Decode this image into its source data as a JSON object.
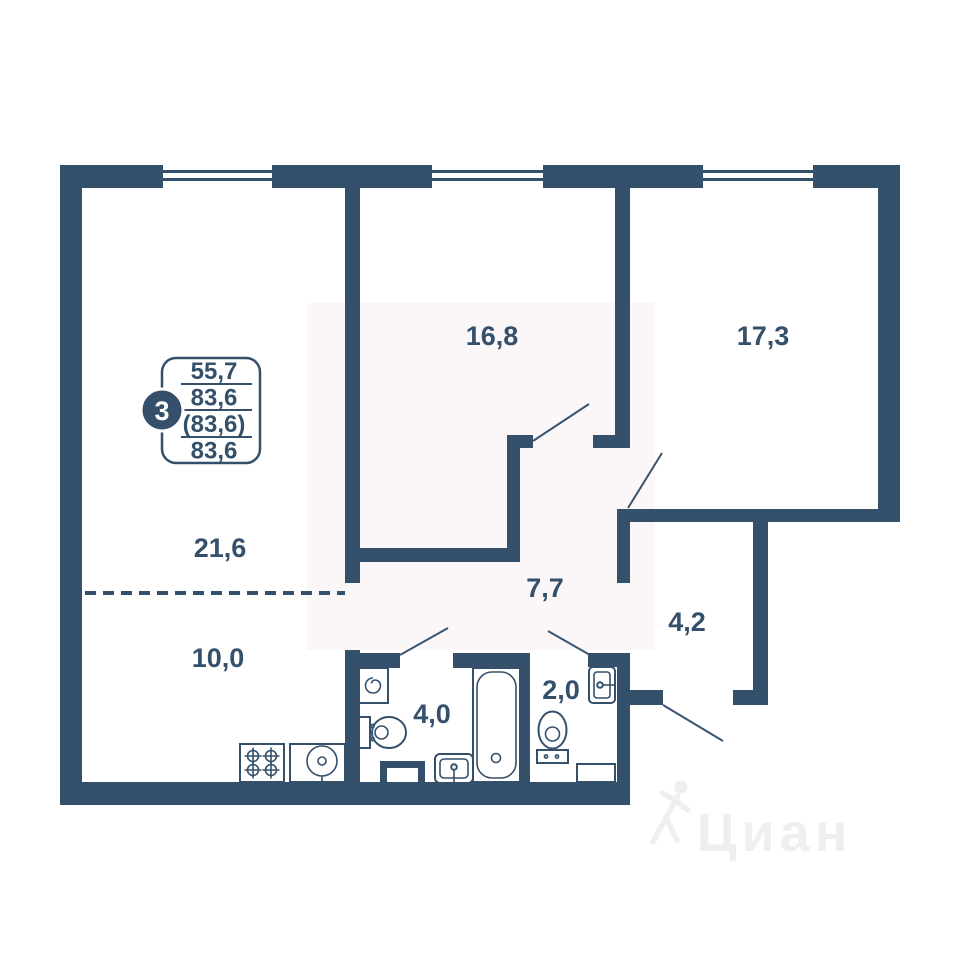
{
  "badge": {
    "rooms_count": "3",
    "values": [
      "55,7",
      "83,6",
      "(83,6)",
      "83,6"
    ]
  },
  "rooms": {
    "living": "21,6",
    "kitchen": "10,0",
    "bedroom1": "16,8",
    "bedroom2": "17,3",
    "hallway": "7,7",
    "corridor": "4,2",
    "bathroom": "4,0",
    "wc": "2,0"
  },
  "watermark": {
    "brand": "Циан"
  },
  "colors": {
    "wall": "#34506B",
    "background": "#FFFFFF",
    "tint": "#FBF6F8",
    "watermark": "#F1EEF0"
  }
}
